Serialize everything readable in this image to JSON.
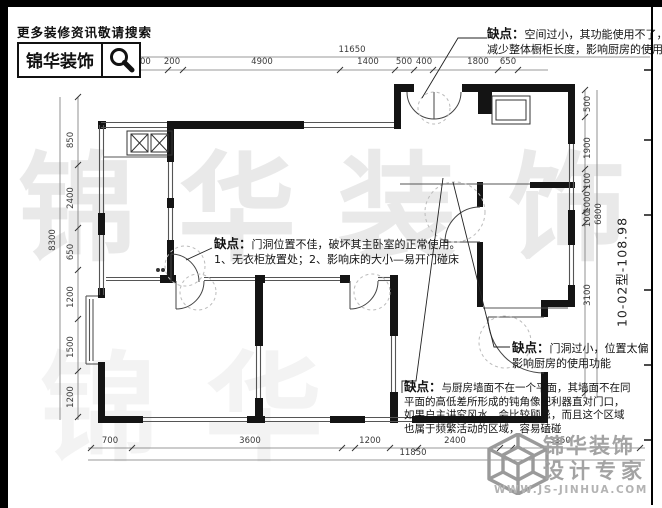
{
  "header": {
    "tagline": "更多装修资讯敬请搜索",
    "brand": "锦华装饰",
    "search_icon": "magnifier-icon"
  },
  "plan": {
    "type_label": "10-02型-108.98"
  },
  "watermark": {
    "chars": [
      "锦",
      "华",
      "装",
      "饰"
    ],
    "color": "#8c8c8c"
  },
  "annotations": [
    {
      "label": "缺点：",
      "lines": [
        "空间过小，其功能使用不了，",
        "减少整体橱柜长度，影响厨房的使用功能"
      ]
    },
    {
      "label": "缺点：",
      "lines": [
        "门洞位置不佳，破坏其主卧室的正常使用。",
        "1、无衣柜放置处；2、影响床的大小—易开门碰床"
      ]
    },
    {
      "label": "缺点：",
      "lines": [
        "门洞过小，位置太偏",
        "影响厨房的使用功能"
      ]
    },
    {
      "label": "缺点：",
      "lines": [
        "与厨房墙面不在一个平面，其墙面不在同",
        "平面的高低差所形成的钝角像把利器直对门口，",
        "如果户主讲究风水，会比较顾忌，而且这个区域",
        "也属于频繁活动的区域，容易磕碰"
      ]
    }
  ],
  "dimensions": {
    "top": {
      "total": "11650",
      "segments": [
        "1400",
        "200",
        "4900",
        "1400",
        "500",
        "400",
        "1800",
        "650"
      ]
    },
    "bottom": {
      "total": "11850",
      "segments": [
        "700",
        "3600",
        "1200",
        "2400",
        "3350"
      ]
    },
    "left": {
      "total": "8300",
      "segments": [
        "850",
        "2400",
        "650",
        "1200",
        "1500",
        "1200"
      ]
    },
    "right": {
      "total": "6800",
      "segments": [
        "500",
        "1900",
        "100",
        "1000",
        "100",
        "3100"
      ]
    }
  },
  "footer": {
    "cube_icon": "cube-logo-icon",
    "brand_line1": "锦华装饰",
    "brand_line2": "设计专家",
    "website": "WWW.JS-JINHUA.COM",
    "logo_color": "#a3a3a3"
  },
  "colors": {
    "wall": "#141414",
    "dimension": "#3a3a3a",
    "dashed_marks": "#bbbbbb"
  }
}
